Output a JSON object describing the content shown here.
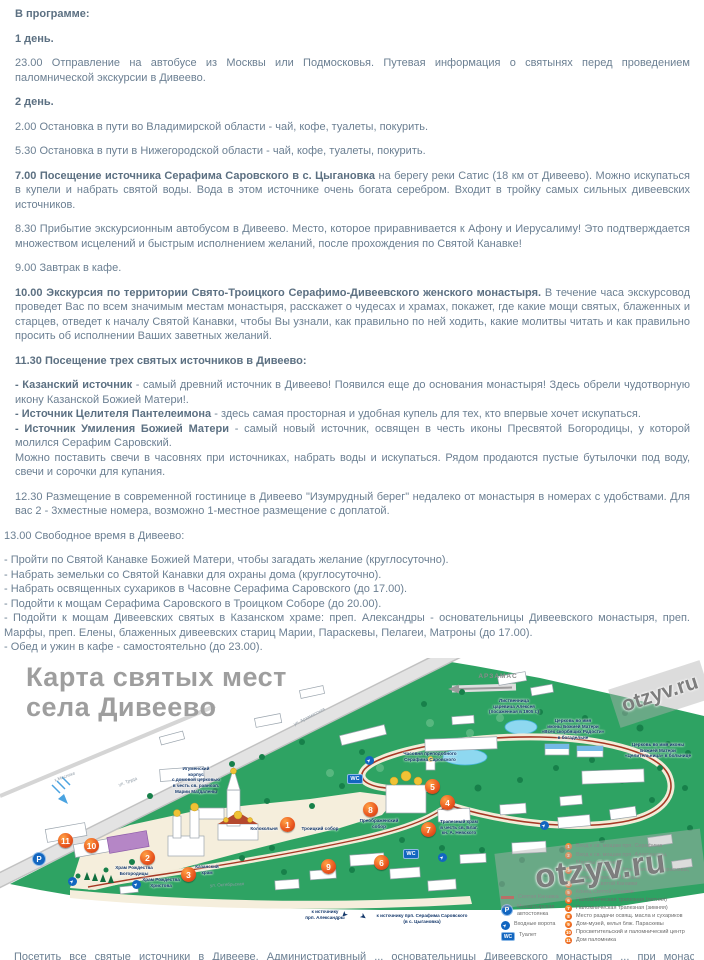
{
  "program": {
    "paragraphs": [
      {
        "lead": "В программе:",
        "rest": ""
      },
      {
        "lead": "1 день.",
        "rest": ""
      },
      {
        "lead": "",
        "rest": "23.00 Отправление на автобусе из Москвы или Подмосковья. Путевая информация о святынях перед проведением паломнической экскурсии в Дивеево."
      },
      {
        "lead": "2 день.",
        "rest": ""
      },
      {
        "lead": "",
        "rest": "2.00 Остановка в пути во Владимирской области - чай, кофе, туалеты, покурить."
      },
      {
        "lead": "",
        "rest": "5.30 Остановка в пути в Нижегородской области - чай, кофе, туалеты, покурить."
      },
      {
        "lead": "7.00 Посещение источника Серафима Саровского в с. Цыгановка",
        "rest": " на берегу реки Сатис (18 км от Дивеево). Можно искупаться в купели и набрать святой воды. Вода в этом источнике очень богата серебром. Входит в тройку самых сильных дивеевских источников."
      },
      {
        "lead": "",
        "rest": "8.30 Прибытие экскурсионным автобусом в Дивеево. Место, которое приравнивается к Афону и Иерусалиму! Это подтверждается множеством исцелений и быстрым исполнением желаний, после прохождения по Святой Канавке!"
      },
      {
        "lead": "",
        "rest": "9.00 Завтрак в кафе."
      },
      {
        "lead": "10.00 Экскурсия по территории Свято-Троицкого Серафимо-Дивеевского женского монастыря.",
        "rest": " В течение часа экскурсовод проведет Вас по всем значимым местам монастыря, расскажет о чудесах и храмах, покажет, где какие мощи святых, блаженных и старцев, отведет к началу Святой Канавки, чтобы Вы узнали, как правильно по ней ходить, какие молитвы читать и как правильно просить об исполнении Ваших заветных желаний."
      },
      {
        "lead": "11.30 Посещение трех святых источников в Дивеево:",
        "rest": ""
      },
      {
        "lead": "- Казанский источник",
        "rest": " - самый древний источник в Дивеево! Появился еще до основания монастыря! Здесь обрели чудотворную икону Казанской Божией Матери!."
      },
      {
        "lead": "- Источник Целителя Пантелеимона",
        "rest": " - здесь самая просторная и удобная купель для тех, кто впервые хочет искупаться."
      },
      {
        "lead": "- Источник Умиления Божией Матери",
        "rest": " - самый новый источник, освящен в честь иконы Пресвятой Богородицы, у которой молился Серафим Саровский."
      },
      {
        "lead": "",
        "rest": "Можно поставить свечи в часовнях при источниках, набрать воды и искупаться. Рядом продаются пустые бутылочки под воду, свечи и сорочки для купания."
      },
      {
        "lead": "",
        "rest": "12.30 Размещение в современной гостинице в Дивеево \"Изумрудный берег\" недалеко от монастыря в номерах с удобствами. Для вас 2 - 3хместные номера, возможно 1-местное размещение с доплатой."
      },
      {
        "lead": "",
        "rest": "13.00 Свободное время в Дивеево:"
      },
      {
        "lead": "",
        "rest": "- Пройти по Святой Канавке Божией Матери, чтобы загадать желание (круглосуточно)."
      },
      {
        "lead": "",
        "rest": "- Набрать земельки со Святой Канавки для охраны дома (круглосуточно)."
      },
      {
        "lead": "",
        "rest": "- Набрать освященных сухариков в Часовне Серафима Саровского (до 17.00)."
      },
      {
        "lead": "",
        "rest": "- Подойти к мощам Серафима Саровского в Троицком Соборе (до 20.00)."
      },
      {
        "lead": "",
        "rest": "- Подойти к мощам Дивеевских святых в Казанском храме: преп. Александры - основательницы Дивеевского монастыря, преп. Марфы, преп. Елены, блаженных дивеевских стариц Марии, Параскевы, Пелагеи, Матроны (до 17.00)."
      },
      {
        "lead": "",
        "rest": "- Обед и ужин в кафе - самостоятельно (до 23.00)."
      }
    ]
  },
  "map": {
    "title_line1": "Карта святых мест",
    "title_line2": "села Дивеево",
    "city_arrow_label": "АРЗАМАС",
    "watermark": "otzyv.ru",
    "wc_label": "WC",
    "parking_label": "P",
    "markers": [
      "1",
      "2",
      "3",
      "4",
      "5",
      "6",
      "7",
      "8",
      "9",
      "10",
      "11"
    ],
    "place_labels": [
      "Лиственница\nцаревича Алексея\n(посаженная в 1905 г.)",
      "Церковь во имя\nиконы Божией Матери\n«Всех скорбящих Радости»\nв богадельне",
      "Церковь во имя иконы\nБожией Матери\n«Целительница» в больнице",
      "Игуменский\nкорпус\nс домовой церковью\nв честь св. равноап.\nМарии Магдалены",
      "Колокольня",
      "Троицкий собор",
      "Храм Рождества\nБогородицы",
      "Храм Рождества\nХристова",
      "Казанский\nхрам",
      "Преображенский\nсобор",
      "Трапезный храм\nв честь св. Благ.\nкн. А. Невского",
      "Часовня преподобного\nСерафима Саровского"
    ],
    "street_labels": [
      "ул. Арзамасская",
      "ул. Труда",
      "ул. Октябрьская",
      "к Маслихе"
    ],
    "spring_labels": [
      "к источнику\nпрп. Александры",
      "к источнику прп. Серафима Саровского\n(в с. Цыгановка)"
    ],
    "legend": {
      "symbols": [
        {
          "icon": "kanavka-line",
          "label": "Святая Канавка"
        },
        {
          "icon": "parking",
          "label": "Монастырская\nавтостоянка"
        },
        {
          "icon": "entrance-gate",
          "label": "Входные ворота"
        },
        {
          "icon": "wc",
          "label": "Туалет"
        }
      ],
      "numbered": [
        {
          "n": "1",
          "label": "Вход к св. мощам прп. Серафима"
        },
        {
          "n": "2",
          "label": "Вход к св. мощам прп. Александры,\nМарфы и Елены"
        },
        {
          "n": "3",
          "label": "Вход к св. мощам блж. Пелагеи, Параскевы,\nМарии и присп. Матроны"
        },
        {
          "n": "4",
          "label": "Начало Святой Канавки"
        },
        {
          "n": "5",
          "label": "Конец Святой Канавки"
        },
        {
          "n": "6",
          "label": "Паломническая трапезная (летняя)"
        },
        {
          "n": "7",
          "label": "Паломническая трапезная (зимняя)"
        },
        {
          "n": "8",
          "label": "Место раздачи освящ. масла и сухариков"
        },
        {
          "n": "9",
          "label": "Дом-музей, келья блж. Параскевы"
        },
        {
          "n": "10",
          "label": "Просветительский и паломнический центр"
        },
        {
          "n": "11",
          "label": "Дом паломника"
        }
      ]
    },
    "clipped_bottom_text": "Посетить все святые источники в Дивееве. Административный ... основательницы Дивеевского монастыря ... при монастыре ..."
  },
  "colors": {
    "text_slate": "#6b7f92",
    "map_green": "#2ea363",
    "marker_orange": "#e8541e",
    "kanavka_red": "#a63824",
    "icon_blue": "#1266c0",
    "title_gray": "#9e9e9e"
  }
}
